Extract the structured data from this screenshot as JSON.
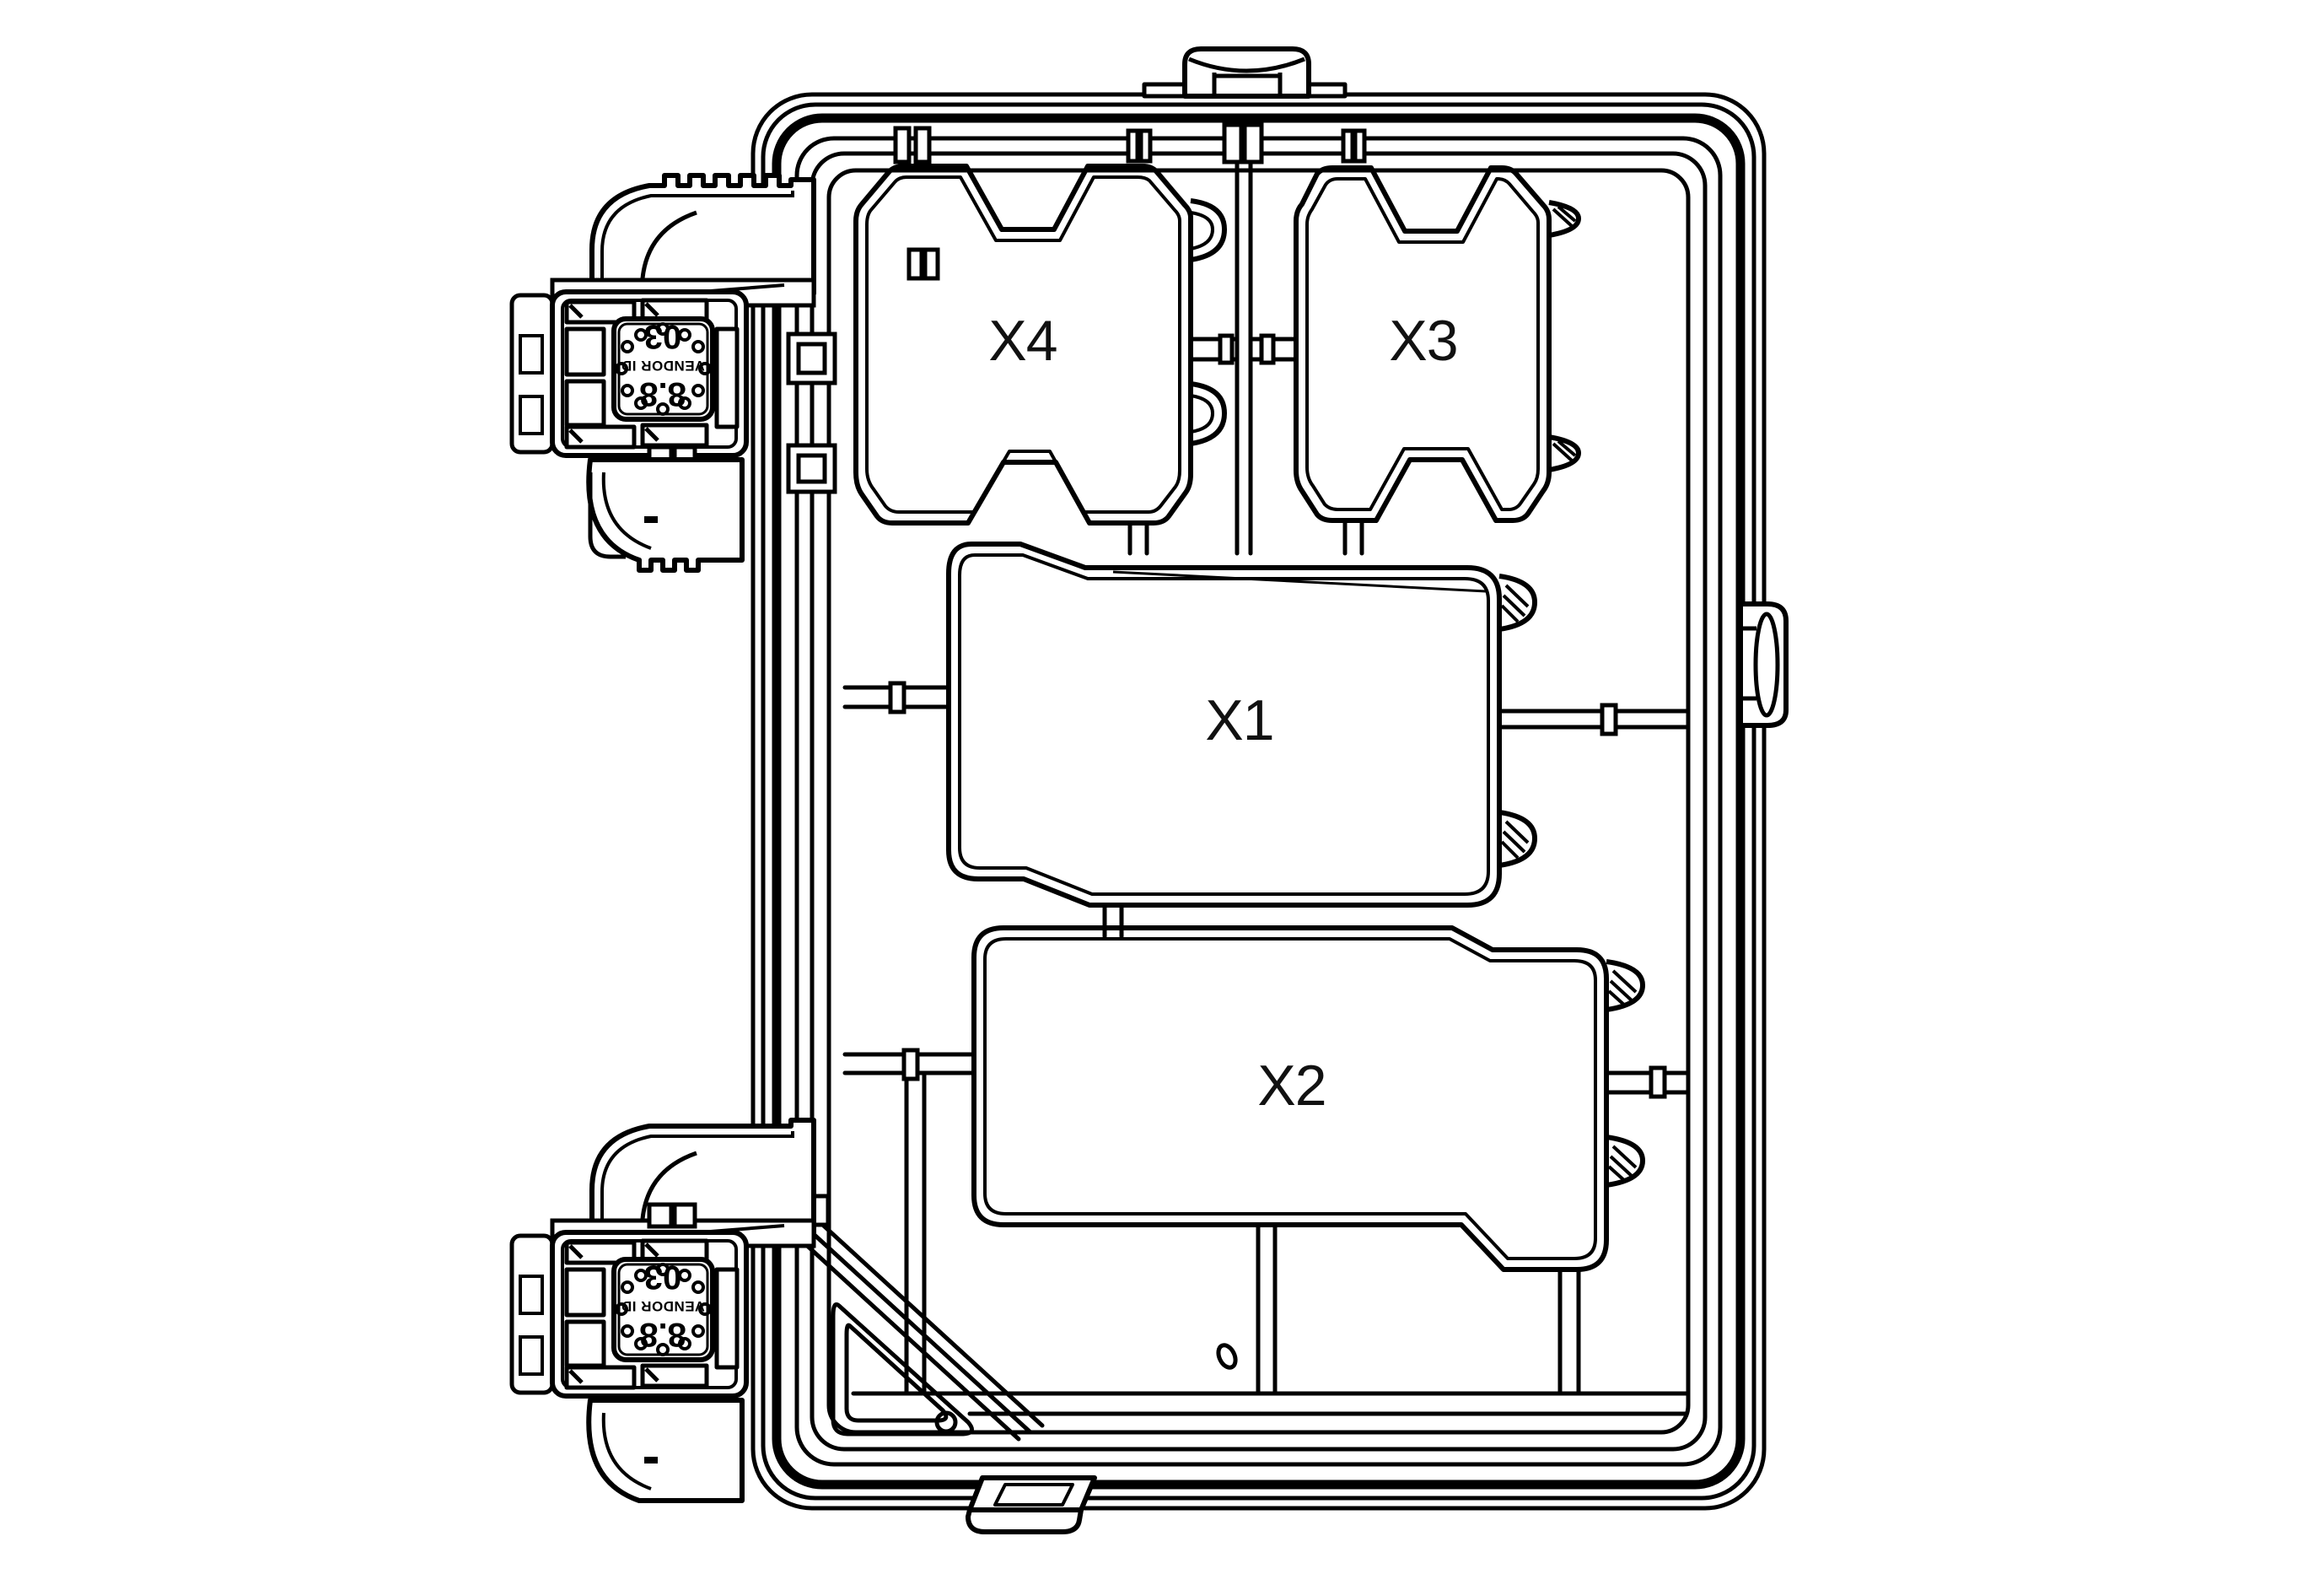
{
  "drawing": {
    "title": "Junction box connector face technical line drawing",
    "colors": {
      "line": "#000000",
      "background": "#ffffff",
      "label_text": "#111111"
    },
    "cavity_labels": {
      "x1": "X1",
      "x2": "X2",
      "x3": "X3",
      "x4": "X4"
    },
    "aux_connector_face": {
      "code_line": "03",
      "vendor_line": "VENDOR ID",
      "gauge_line": "8.8",
      "text_orientation": "rotated-180"
    }
  }
}
